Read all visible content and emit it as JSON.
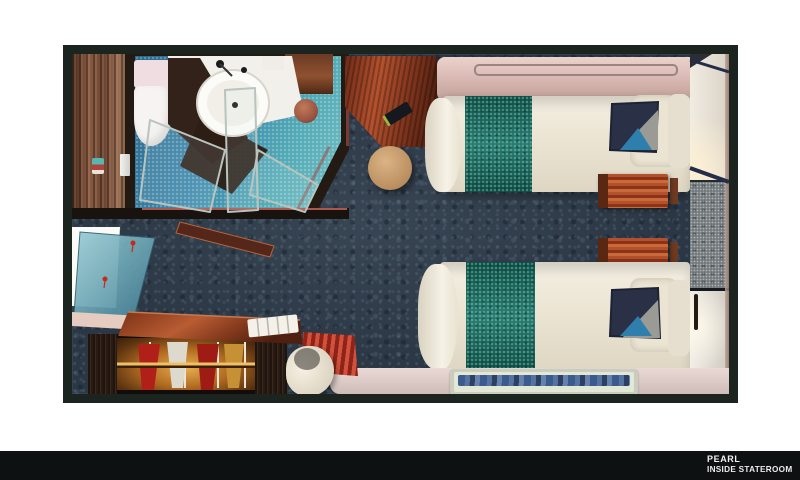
{
  "footer": {
    "brand": "PEARL",
    "room_type": "INSIDE STATEROOM"
  },
  "palette": {
    "background": "#ffffff",
    "footer_bar": "#0e1111",
    "plan_border": "#1c2420",
    "carpet_navy": "#2b3744",
    "bathroom_tile_blue": "#3a86ab",
    "shower_tile_seafoam": "#6fc2b4",
    "bed_runner_teal": "#0f6d61",
    "duvet_cream": "#f0ead9",
    "wood_red": "#a0502c",
    "wood_dark": "#2a1b12",
    "pullman_pink": "#dcbab4",
    "cushion_navy": "#2a3146",
    "cushion_blue": "#2f7fae",
    "cushion_grey": "#9b9b95",
    "closet_glow_amber": "#c98a30",
    "garment_red": "#b02018",
    "garment_gold": "#c69134",
    "mat_wave_blue": "#2c4f86",
    "mirror_teal": "#6fb0bd"
  },
  "floorplan": {
    "rooms": [
      {
        "name": "bathroom"
      },
      {
        "name": "entry"
      },
      {
        "name": "sleeping-area"
      }
    ],
    "furniture": [
      "toilet",
      "vanity-counter",
      "sink-basin",
      "shower-enclosure-glass",
      "shower-drain-mat",
      "entry-wood-floor",
      "upper-desk",
      "round-stool",
      "pullman-berth-panel",
      "twin-bed-upper",
      "twin-bed-lower",
      "bed-runner",
      "bed-pillow",
      "accent-cushion",
      "nightstand-upper",
      "nightstand-lower",
      "cabin-door-panels",
      "marble-wall-panel",
      "leaning-mirror",
      "wardrobe-closet",
      "hanging-garments",
      "writing-desk",
      "towel-stack",
      "red-ottoman",
      "white-armchair",
      "floor-mat",
      "beige-floor-strip"
    ]
  }
}
